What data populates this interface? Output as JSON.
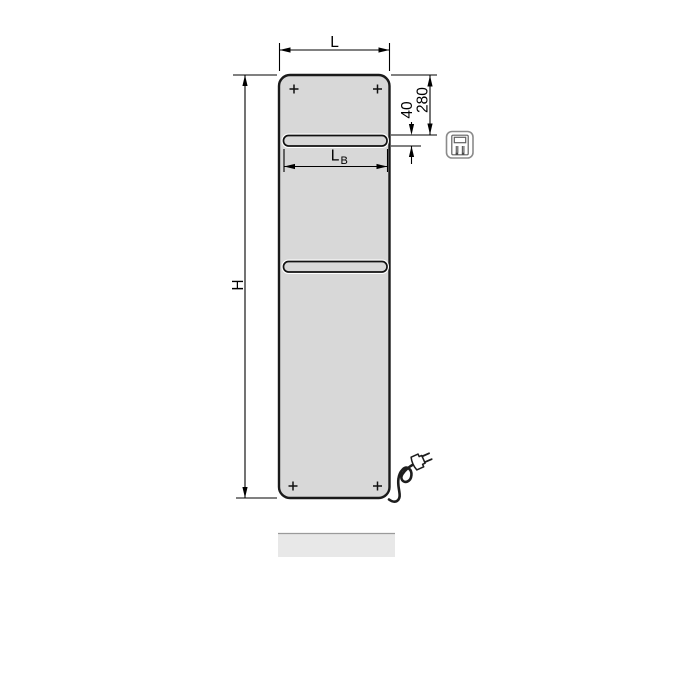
{
  "diagram": {
    "dimension_labels": {
      "overall_width": "L",
      "overall_height": "H",
      "rail_width_base": "L",
      "rail_width_subscript": "B",
      "top_offset": "280",
      "rail_thickness": "40"
    },
    "icons": {
      "electric_connection": "electric-plug-icon",
      "corner_screws": "screw-cross-icon",
      "power_cord": "power-plug-icon"
    },
    "colors": {
      "background": "#ffffff",
      "panel_fill": "#d8d8d8",
      "panel_outline": "#1a1a1a",
      "dimension_line": "#000000",
      "cable": "#1d1d1d",
      "shadow_fill": "#e8e8e8",
      "shadow_edge": "#9b9b9b",
      "icon_stroke": "#8b8b8b"
    }
  }
}
